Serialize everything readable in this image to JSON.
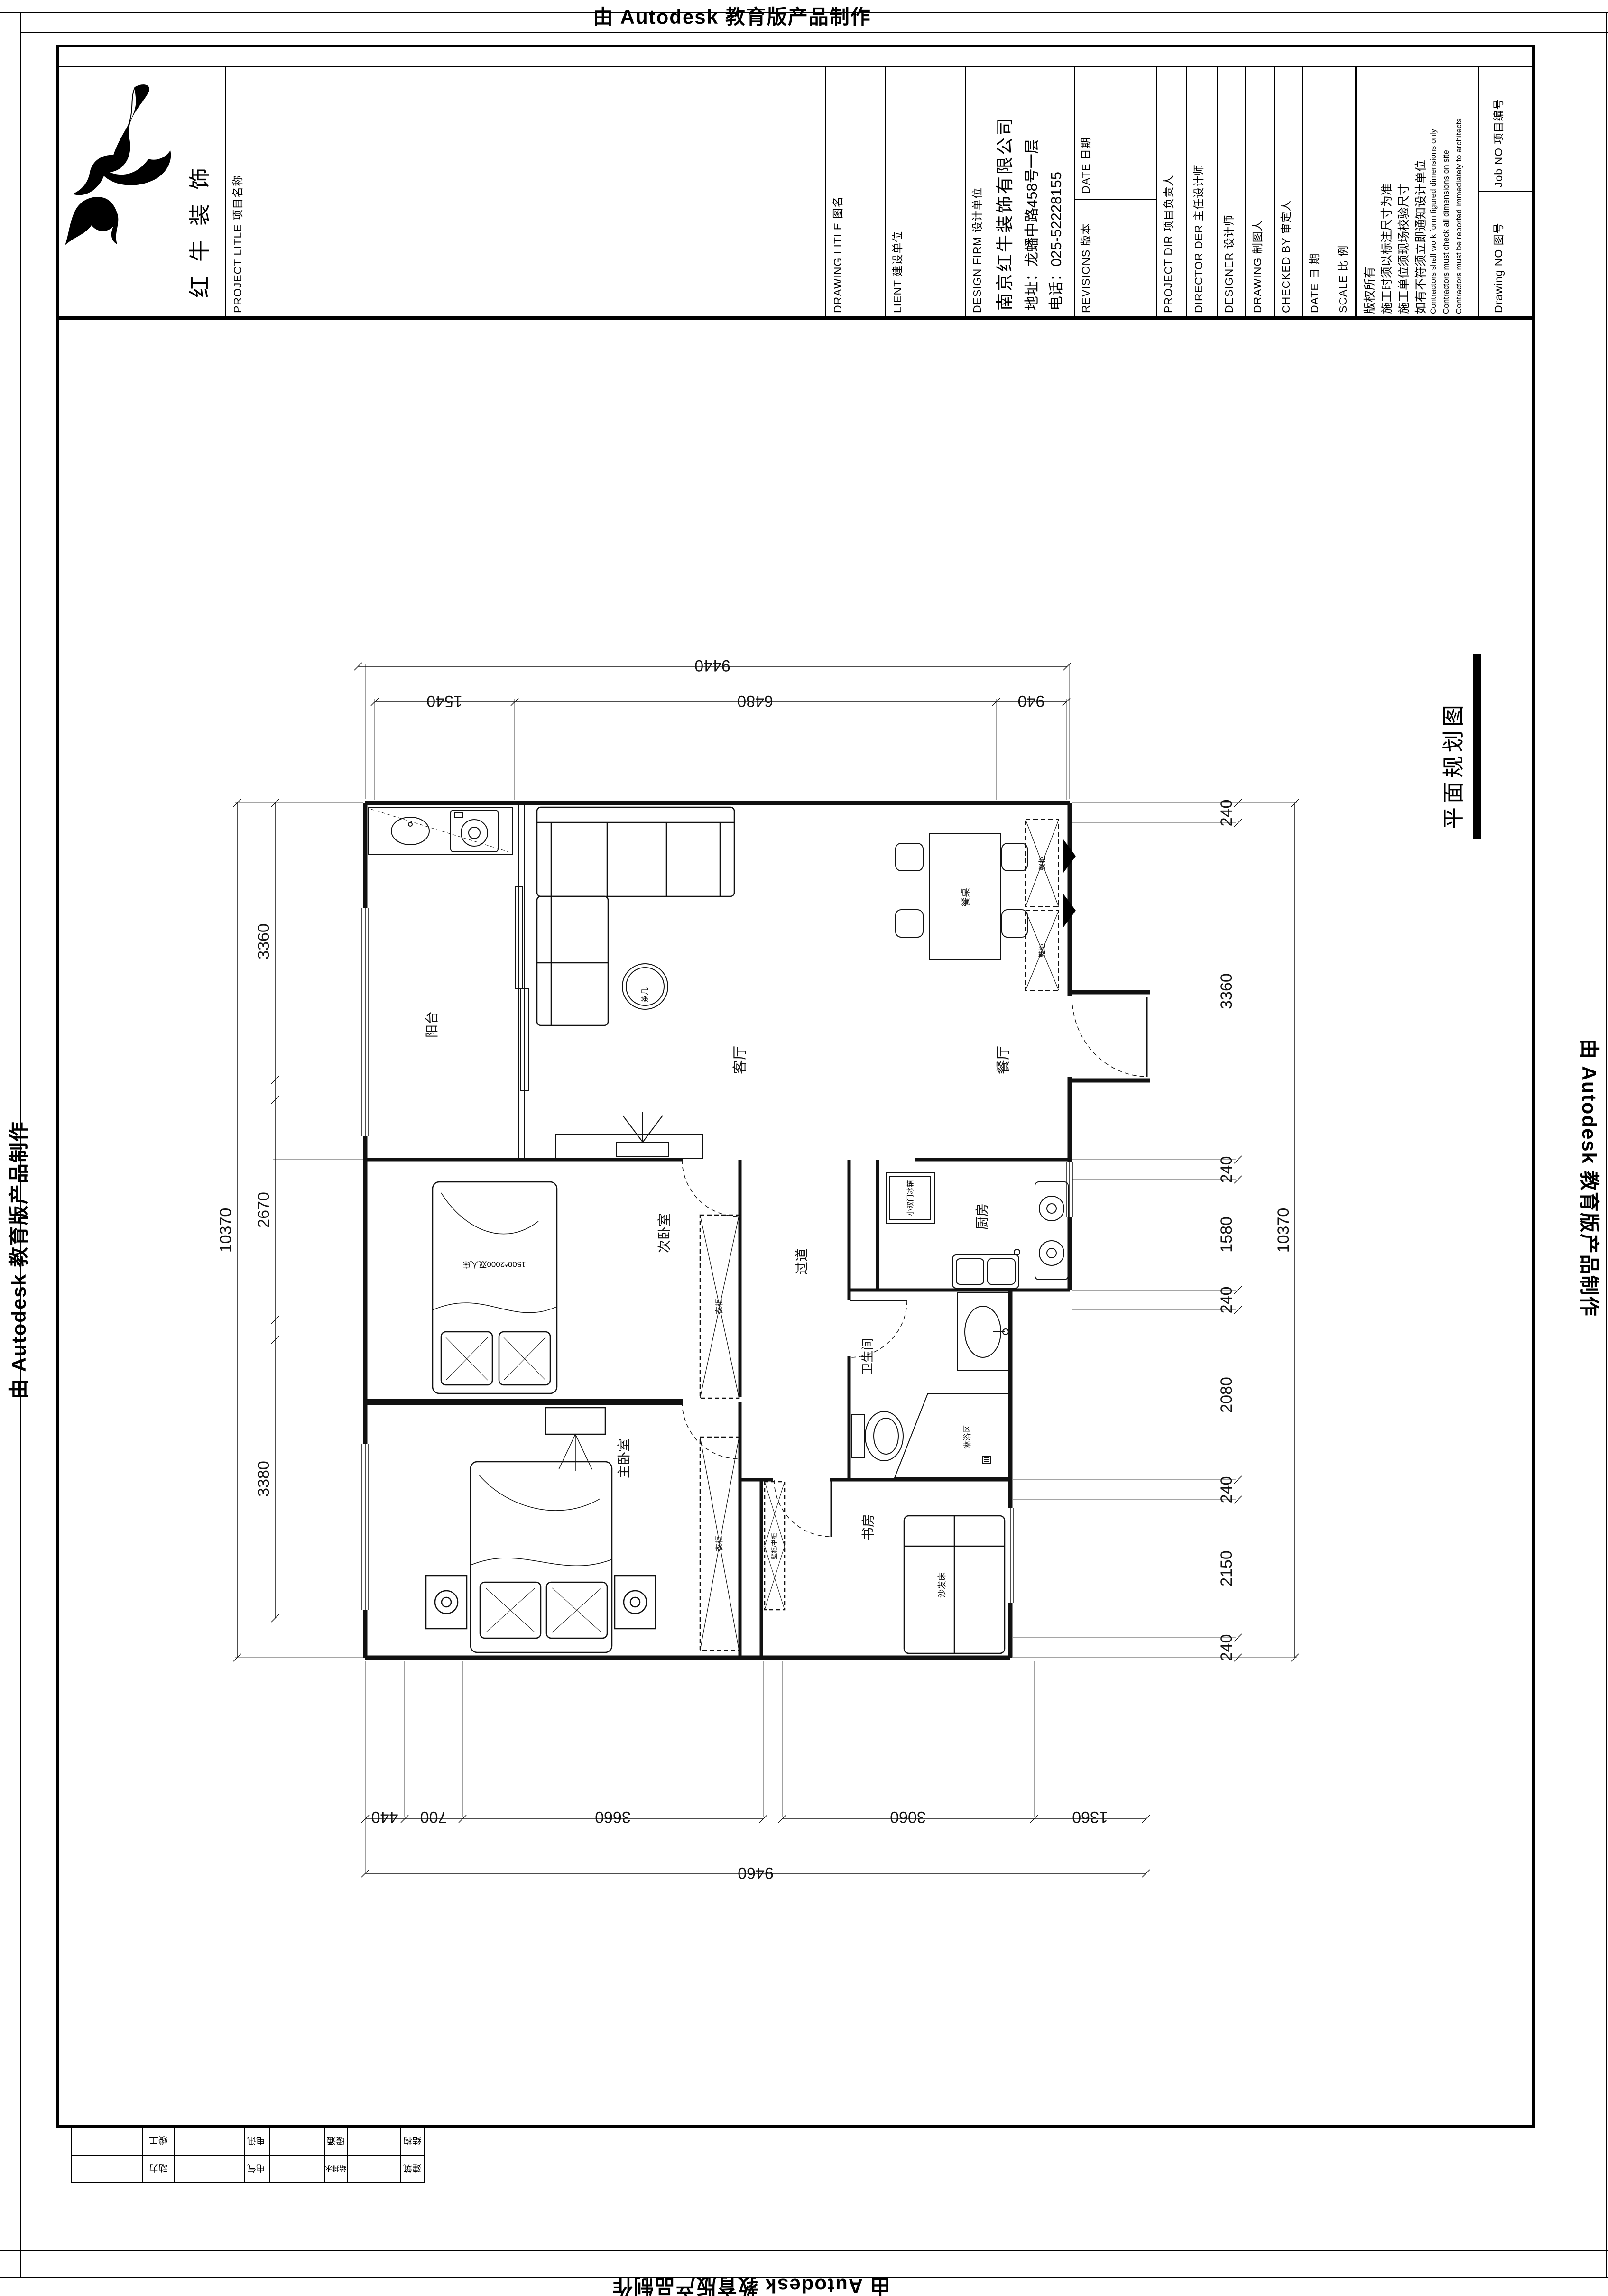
{
  "watermark": {
    "text": "由 Autodesk 教育版产品制作"
  },
  "plan_title": "平面规划图",
  "titleblock": {
    "logo_text": "红牛装饰",
    "project_label": "PROJECT LITLE  项目名称",
    "drawing_label": "DRAWING LITLE  图名",
    "client_label": "LIENT  建设单位",
    "firm_label": "DESIGN FIRM  设计单位",
    "firm_name": "南京红牛装饰有限公司",
    "firm_address": "地址：龙蟠中路458号一层",
    "firm_phone": "电话：025-52228155",
    "revisions_label": "REVISIONS  版本",
    "date_label": "DATE  日期",
    "project_dir_label": "PROJECT DIR  项目负责人",
    "director_label": "DIRECTOR DER  主任设计师",
    "designer_label": "DESIGNER  设计师",
    "drafter_label": "DRAWING  制图人",
    "checked_label": "CHECKED BY  审定人",
    "date2_label": "DATE  日  期",
    "scale_label": "SCALE  比  例",
    "copyright": "版权所有",
    "note1": "施工时须以标注尺寸为准",
    "note2": "施工单位须现场校验尺寸",
    "note3": "如有不符须立即通知设计单位",
    "note_en1": "Contractors shall  work form figured dimensions only",
    "note_en2": "Contractors must check all  dimensions on site",
    "note_en3": "Contractors must  be reported immediately  to architects",
    "job_no_label": "Job NO  项目编号",
    "drawing_no_label": "Drawing NO  图号"
  },
  "rooms": {
    "balcony": "阳台",
    "living": "客厅",
    "dining": "餐厅",
    "kitchen": "厨房",
    "hallway": "过道",
    "bedroom2": "次卧室",
    "master": "主卧室",
    "bathroom": "卫生间",
    "study": "书房"
  },
  "furniture": {
    "tea_table": "茶几",
    "dining_table": "餐桌",
    "cabinet1": "餐柜",
    "cabinet2": "鞋柜",
    "wardrobe1": "衣柜",
    "wardrobe2": "衣柜",
    "bed2": "1500*2000双人床",
    "fridge": "小双门冰箱",
    "shower": "淋浴区",
    "sofa_bed": "沙发床",
    "bookcase": "壁柜/书柜"
  },
  "dims": {
    "top": {
      "total": "9440",
      "segments": [
        "1540",
        "6480",
        "940"
      ]
    },
    "bottom": {
      "total": "9460",
      "segments": [
        "440",
        "700",
        "3660",
        "3060",
        "1360"
      ]
    },
    "left": {
      "total": "10370",
      "segments": [
        "3360",
        "2670",
        "3380"
      ]
    },
    "right": {
      "total": "10370",
      "segments": [
        "240",
        "3360",
        "240",
        "1580",
        "240",
        "2080",
        "240",
        "2150",
        "240"
      ]
    }
  },
  "sign_table": {
    "row1": [
      "竣工",
      "电讯",
      "暖通",
      "结构"
    ],
    "row2": [
      "动力",
      "电气",
      "给排水",
      "建筑"
    ]
  }
}
